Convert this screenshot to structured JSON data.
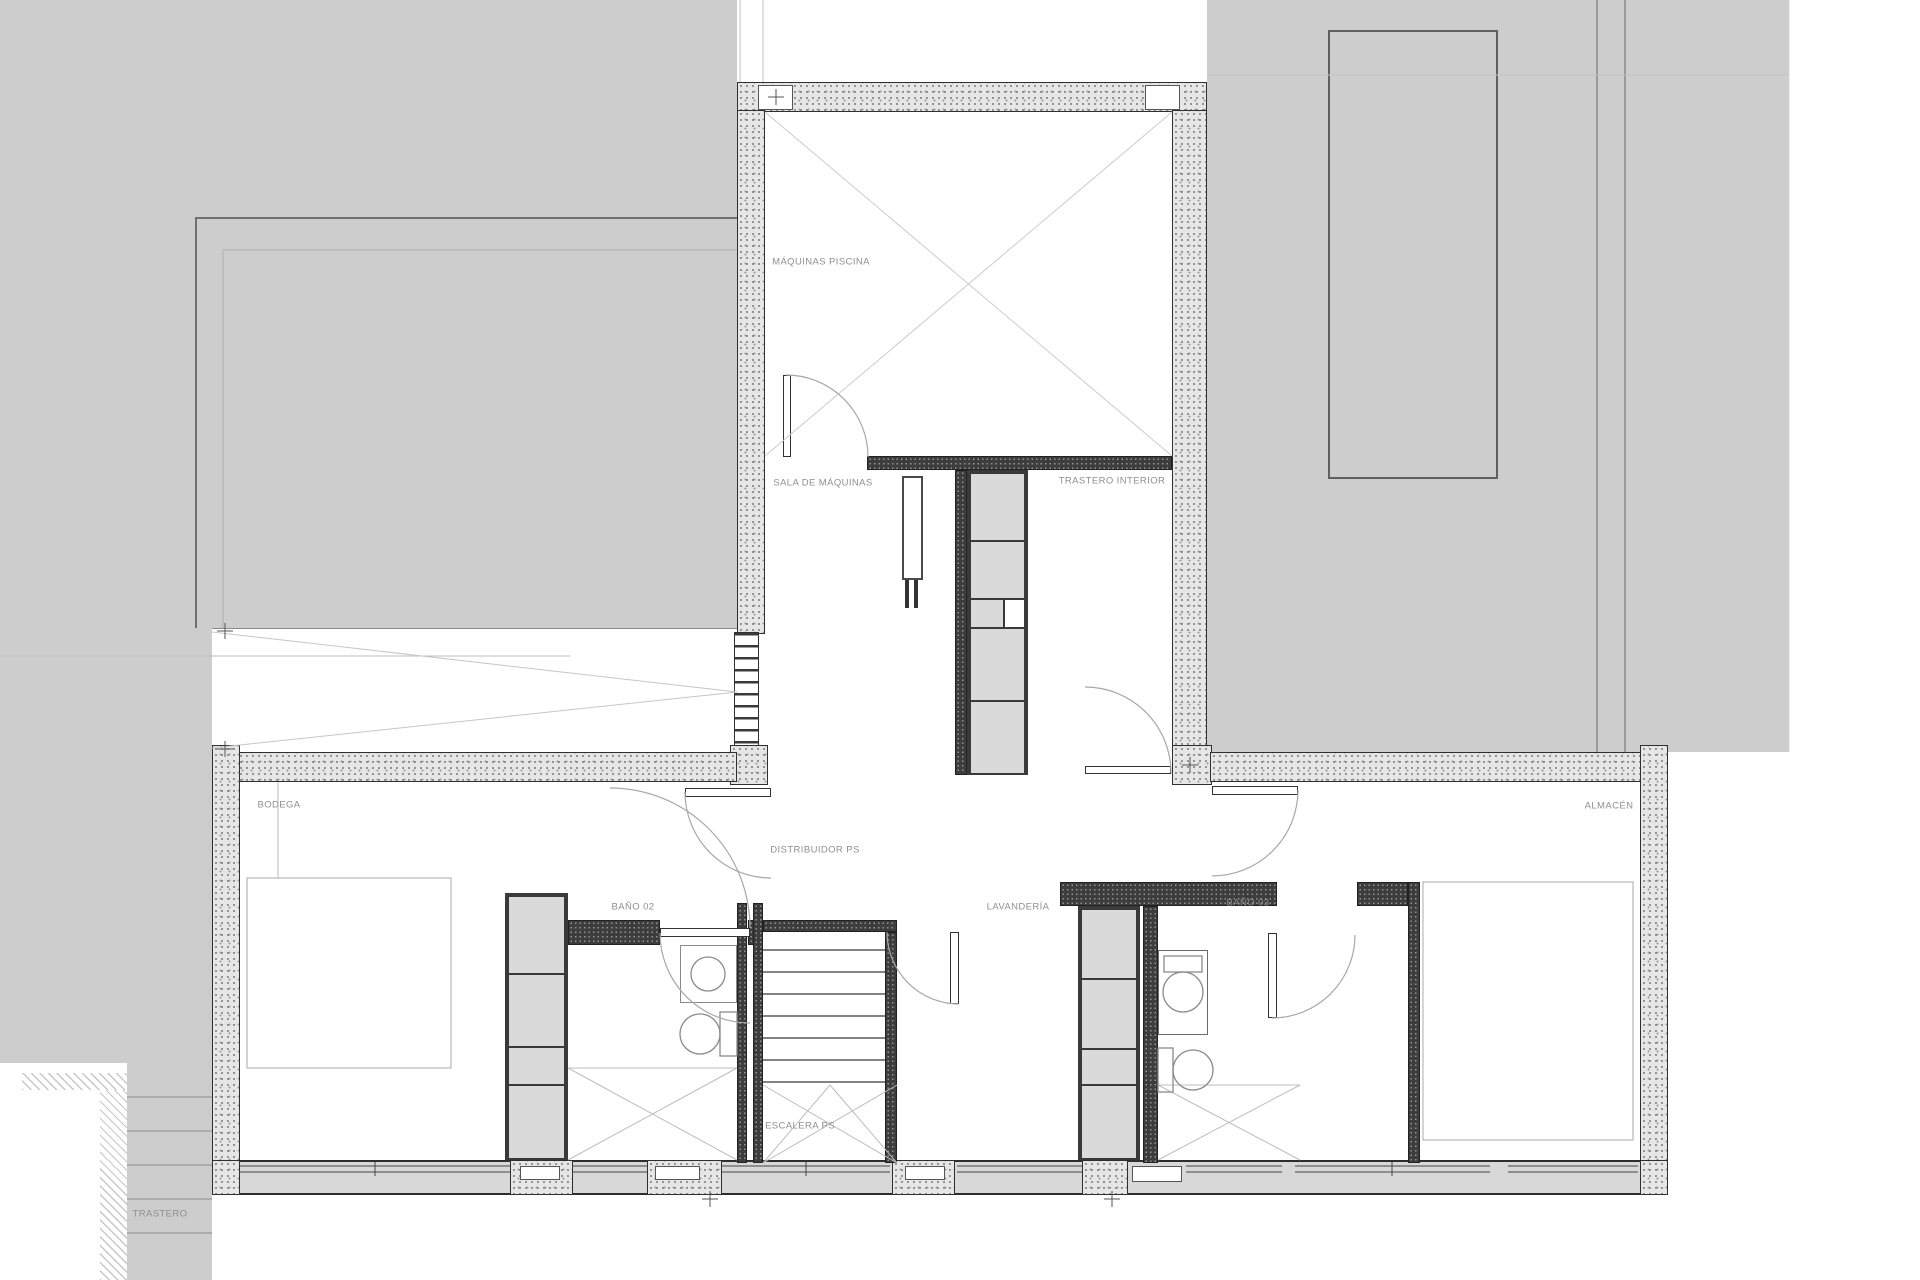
{
  "drawing": {
    "kind": "architectural-floor-plan",
    "floor_code": "PS",
    "labels": {
      "maquinas_piscina": "MÁQUINAS PISCINA",
      "sala_de_maquinas": "SALA DE MÁQUINAS",
      "trastero_interior": "TRASTERO INTERIOR",
      "bodega": "BODEGA",
      "distribuidor": "DISTRIBUIDOR PS",
      "bano_02": "BAÑO 02",
      "escalera": "ESCALERA PS",
      "lavanderia": "LAVANDERÍA",
      "bano_03": "BAÑO 03",
      "almacen": "ALMACÉN",
      "trastero": "TRASTERO"
    },
    "colors": {
      "terrace_gray": "#cdcdcd",
      "concrete_wall_fill": "#e6e6e6",
      "partition_dark": "#3d3d3d",
      "cabinet_cell": "#dadada",
      "label_text": "#8f8f8f",
      "thin_line": "#b9b9b9"
    }
  }
}
